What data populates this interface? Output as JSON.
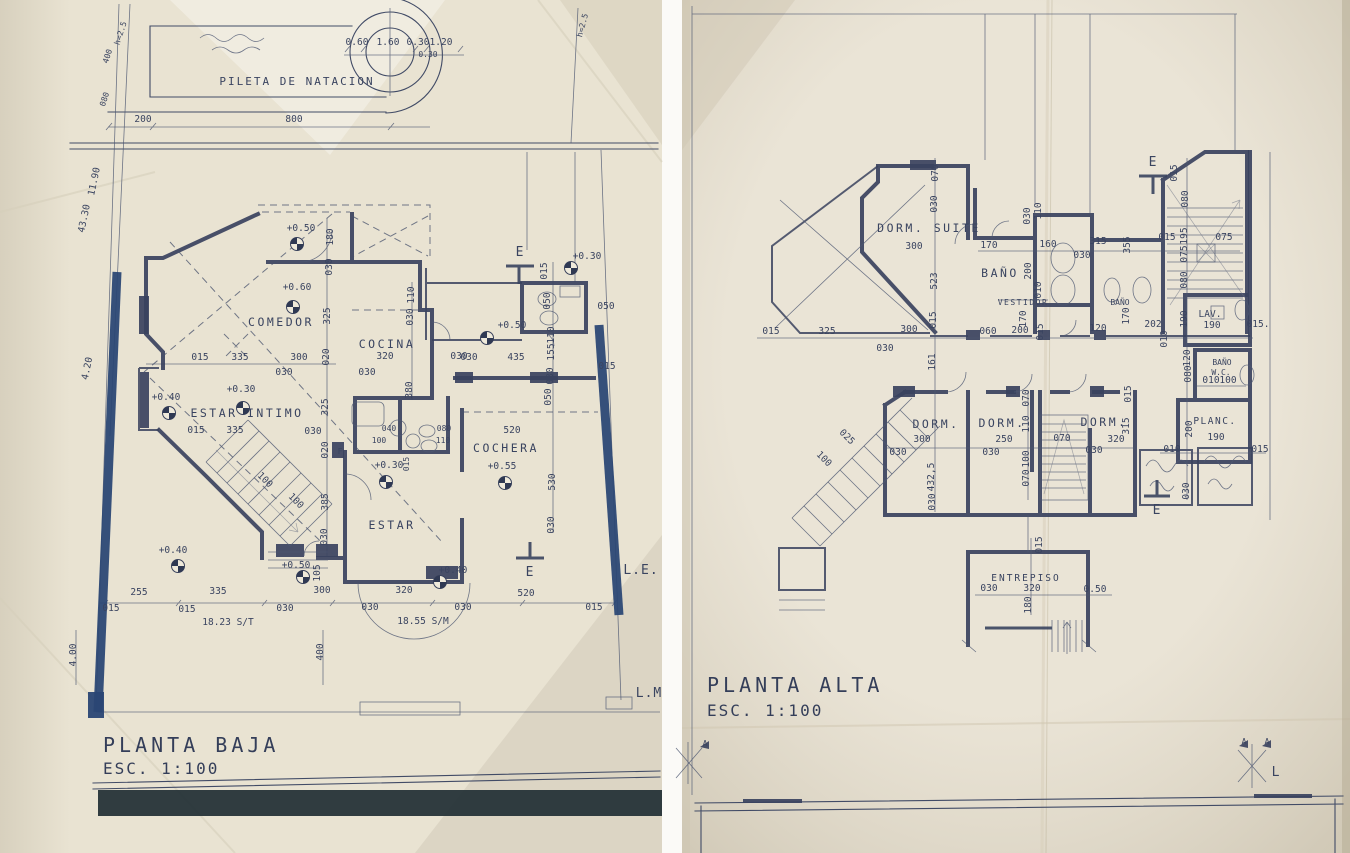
{
  "colors": {
    "ink": "#3a4460",
    "navy_highlight": "#2a4674",
    "paper_left": "#e9e3d2",
    "paper_right": "#eae4d6",
    "table_edge": "#1f2e33"
  },
  "left_plan": {
    "title": "PLANTA BAJA",
    "scale": "ESC. 1:100",
    "rooms": {
      "pool": "PILETA DE NATACION",
      "comedor": "COMEDOR",
      "cocina": "COCINA",
      "estar_intimo": "ESTAR INTIMO",
      "estar": "ESTAR",
      "cochera": "COCHERA",
      "fireplace": "F"
    },
    "marks": {
      "section": "E",
      "lm": "L.M",
      "le": "L.E."
    },
    "levels": [
      "+0.50",
      "+0.60",
      "+0.30",
      "+0.40",
      "+0.30",
      "+0.50",
      "+0.30",
      "+0.55",
      "+0.40",
      "+0.50",
      "+0.40"
    ],
    "dims": [
      "0.60",
      "1.60",
      "0.30",
      "1.20",
      "0.30",
      "200",
      "800",
      "h=2.5",
      "400",
      "080",
      "11.90",
      "43.30",
      "4.20",
      "h=2.5",
      "180",
      "030",
      "325",
      "020",
      "015",
      "335",
      "300",
      "030",
      "030",
      "110",
      "030",
      "320",
      "030",
      "380",
      "335",
      "030",
      "325",
      "020",
      "385",
      "030",
      "015",
      "100",
      "100",
      "435",
      "030",
      "015",
      "050",
      "050",
      "110",
      "155",
      "030",
      "050",
      "015",
      "040",
      "080",
      "110",
      "100",
      "015",
      "520",
      "530",
      "030",
      "105",
      "255",
      "335",
      "300",
      "320",
      "015",
      "015",
      "030",
      "030",
      "030",
      "18.23 S/T",
      "18.55 S/M",
      "4.00",
      "400",
      "520",
      "015"
    ]
  },
  "right_plan": {
    "title": "PLANTA ALTA",
    "scale": "ESC. 1:100",
    "rooms": {
      "dorm_suite": "DORM. SUITE",
      "banio": "BAÑO",
      "vestidor": "VESTIDOR",
      "banio2": "BAÑO",
      "lav": "LAV.",
      "banio_wc": "BAÑO",
      "wc": "W.C.",
      "planc": "PLANC.",
      "dorm1": "DORM.",
      "dorm2": "DORM.",
      "dorm3": "DORM.",
      "entrepiso": "ENTREPISO"
    },
    "marks": {
      "section": "E",
      "axis_a": "A",
      "axis_l": "L"
    },
    "dims": [
      "070",
      "030",
      "300",
      "523",
      "015",
      "170",
      "200",
      "160",
      "030",
      "110",
      "315",
      "030",
      "355",
      "015",
      "080",
      "015",
      "195",
      "075",
      "075",
      "080",
      "010",
      "060",
      "200",
      "015",
      "170",
      "120",
      "202",
      "170",
      "010",
      "190",
      "190",
      "015.",
      "015",
      "325",
      "300",
      "030",
      "161",
      "100",
      "025",
      "300",
      "030",
      "432,5",
      "030",
      "250",
      "030",
      "320",
      "030",
      "315",
      "015",
      "070",
      "110",
      "100",
      "070",
      "070",
      "120",
      "080",
      "200",
      "010",
      "100",
      "190",
      "010",
      "015",
      "030",
      "015",
      "030",
      "320",
      "0.50",
      "180"
    ]
  }
}
